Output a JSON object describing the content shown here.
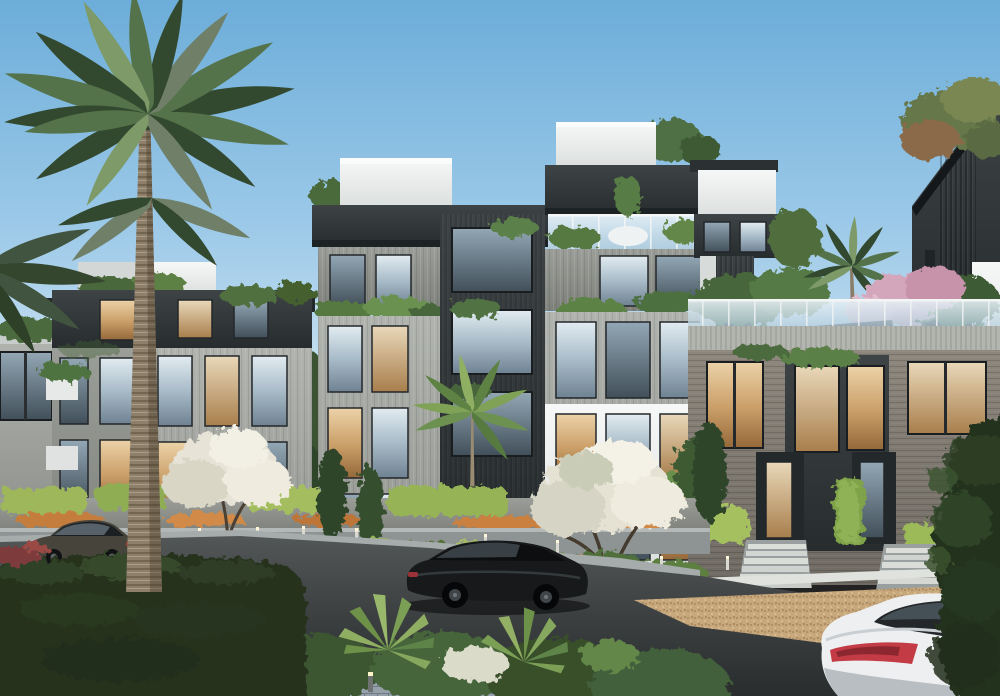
{
  "scene": {
    "title": "Residential compound exterior rendering",
    "description": "Photorealistic daytime architectural rendering of a modern residential compound: gray and charcoal apartment buildings with rooftop gardens and glass balustrades, a tall palm tree, flowering trees, landscaped terraced gardens with bollard lights, a dark asphalt street with a black sedan, a dark gray sedan at left, a white sedan at bottom right, dense green hedges in the foreground and a clear blue sky.",
    "time_of_day": "day",
    "sky": "clear blue, lighter toward horizon",
    "buildings": [
      "background low-rise block at far left",
      "left five-storey building with dark top floor and white penthouse boxes",
      "central twin-tower building with stone facade, charcoal core, rooftop glass balustrades and planted balconies",
      "right townhouse block with brick facade, warm lit windows, rooftop garden with palm and pink flowering tree, twin entrance stairs",
      "far-right dark slatted tower with diagonal roofline and rooftop tree"
    ],
    "vehicles": [
      "dark gray sedan parked on the left street",
      "black sedan driving on the central street",
      "white sedan with red tail lights at bottom right"
    ],
    "vegetation": [
      "tall feather palm on the left",
      "rooftop palm above right townhouse",
      "two white blossom trees",
      "pink flowering trees at right",
      "dark cypress columns",
      "fan palms and shrubs in the foreground strip",
      "large dark clipped hedge in bottom-left foreground",
      "tall hedge along the right edge"
    ],
    "lighting": [
      "garden bollard lights along planted terraces"
    ]
  },
  "palette": {
    "sky_top": "#6cadd9",
    "sky_mid": "#9cc9e8",
    "sky_low": "#cfe4f2",
    "sky_horizon": "#e3f0f7",
    "facade_white": "#eef0ee",
    "facade_stone": "#a3a6a1",
    "facade_charcoal": "#33383a",
    "facade_brick": "#847e75",
    "window_cool": "#a5b8c5",
    "window_warm": "#d3a871",
    "glass_balustrade": "#d3e4ee",
    "palm_dark": "#33492f",
    "palm_mid": "#55734a",
    "palm_light": "#7d9a68",
    "trunk": "#8d7f69",
    "hedge_fore": "#26331e",
    "hedge_light": "#a5c05e",
    "flower_orange": "#c57d3e",
    "blossom_white": "#e7e3d6",
    "blossom_pink": "#d3a6bb",
    "road": "#3e4243",
    "paver": "#97a2ac",
    "gravel": "#c7a77c",
    "wall_gray": "#8e9394",
    "car_black": "#17191b",
    "car_gray": "#47443c",
    "car_white": "#edeff1",
    "taillight": "#c23b45"
  }
}
